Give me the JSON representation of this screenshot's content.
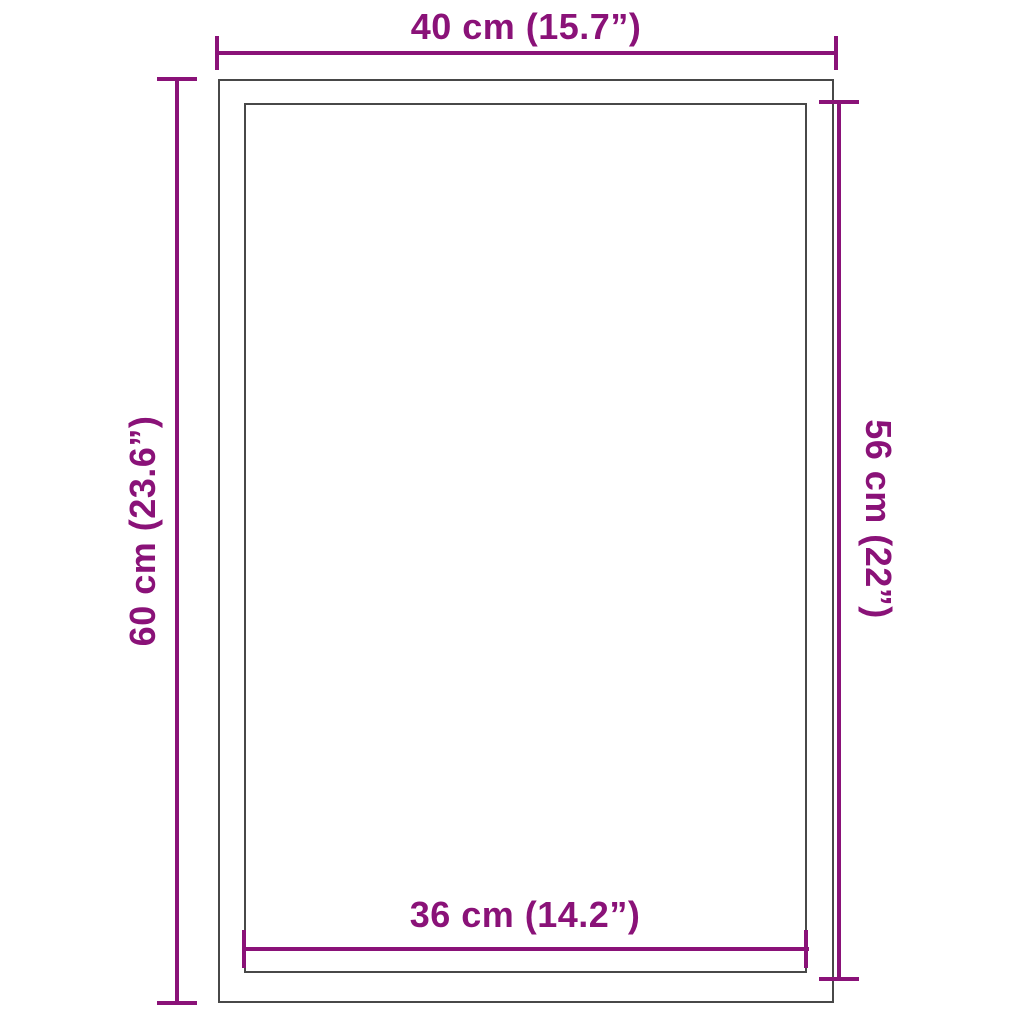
{
  "diagram": {
    "type": "product-dimension-diagram",
    "colors": {
      "dimension": "#8a1278",
      "outline": "#484848",
      "background": "#ffffff"
    },
    "labels": {
      "outer_width": "40 cm (15.7”)",
      "outer_height": "60 cm (23.6”)",
      "inner_height": "56 cm (22”)",
      "inner_width": "36 cm (14.2”)"
    },
    "measurements": {
      "outer_width_cm": 40,
      "outer_width_in": 15.7,
      "outer_height_cm": 60,
      "outer_height_in": 23.6,
      "inner_height_cm": 56,
      "inner_height_in": 22,
      "inner_width_cm": 36,
      "inner_width_in": 14.2
    }
  }
}
